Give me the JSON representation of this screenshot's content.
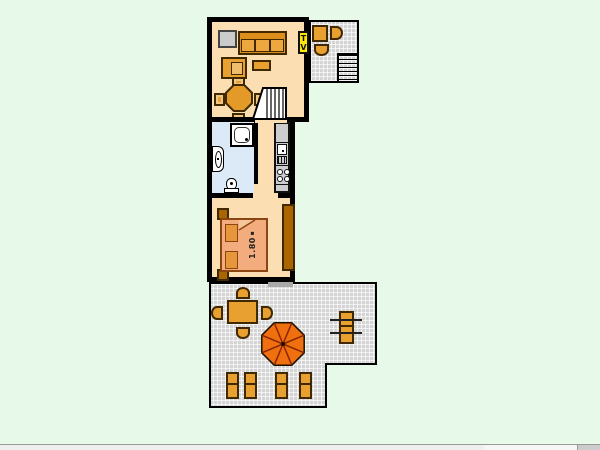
{
  "floor_plan": {
    "living_room": {
      "tv_label": "TV",
      "furniture": [
        "cabinet",
        "sofa",
        "armchair",
        "coffee-table",
        "round-dining-table",
        "four-chairs",
        "stairs"
      ]
    },
    "balcony": {
      "furniture": [
        "table",
        "two-chairs",
        "outdoor-stairs"
      ]
    },
    "bathroom": {
      "fixtures": [
        "shower",
        "washbasin",
        "toilet"
      ]
    },
    "kitchen": {
      "fixtures": [
        "counter",
        "sink",
        "drainer",
        "stove"
      ]
    },
    "bedroom": {
      "bed_width_label": "1.80",
      "furniture": [
        "double-bed",
        "two-pillows",
        "two-nightstands",
        "wardrobe"
      ]
    },
    "terrace": {
      "furniture": [
        "dining-table",
        "four-chairs",
        "parasol",
        "five-sun-loungers"
      ]
    }
  },
  "colors": {
    "background": "#E7FAE9",
    "floor": "#FBDFB2",
    "bathroom_floor": "#DCEAF8",
    "wall": "#000000",
    "furniture_orange": "#E8A030",
    "dark_wood": "#A96500",
    "bed": "#F2AC7D",
    "pillow": "#E8963C",
    "terrace_tile": "#D4D4D4",
    "parasol": "#F07010",
    "tv_yellow": "#FFE900",
    "counter_gray": "#CDCDCD"
  }
}
